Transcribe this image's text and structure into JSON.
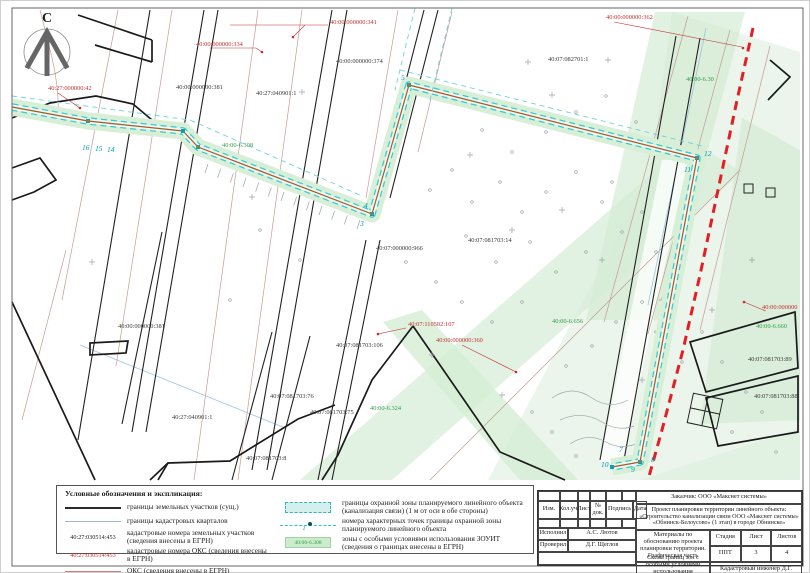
{
  "compass": {
    "north_letter": "С"
  },
  "map": {
    "labels": [
      {
        "text": "40:27:000000:42",
        "x": 48,
        "y": 90,
        "color": "red"
      },
      {
        "text": "40:00:000000:341",
        "x": 330,
        "y": 24,
        "color": "red"
      },
      {
        "text": "40:00:000000:334",
        "x": 196,
        "y": 46,
        "color": "red"
      },
      {
        "text": "40:00:000000:374",
        "x": 336,
        "y": 63,
        "color": "black"
      },
      {
        "text": "40:00:000000:381",
        "x": 176,
        "y": 89,
        "color": "black"
      },
      {
        "text": "40:27:040901:1",
        "x": 256,
        "y": 95,
        "color": "black"
      },
      {
        "text": "40:00:000000:362",
        "x": 606,
        "y": 19,
        "color": "red"
      },
      {
        "text": "40:07:082701:1",
        "x": 548,
        "y": 61,
        "color": "black"
      },
      {
        "text": "40:00-6.30",
        "x": 686,
        "y": 81,
        "color": "green"
      },
      {
        "text": "40:00-6.308",
        "x": 222,
        "y": 147,
        "color": "green"
      },
      {
        "text": "40:07:081703:14",
        "x": 468,
        "y": 242,
        "color": "black"
      },
      {
        "text": "40:07:000000:966",
        "x": 376,
        "y": 250,
        "color": "black"
      },
      {
        "text": "40:00:000000:381",
        "x": 118,
        "y": 328,
        "color": "black"
      },
      {
        "text": "40:27:040901:1",
        "x": 172,
        "y": 419,
        "color": "black"
      },
      {
        "text": "40:07:110502:107",
        "x": 408,
        "y": 326,
        "color": "red"
      },
      {
        "text": "40:00:000000:360",
        "x": 436,
        "y": 342,
        "color": "red"
      },
      {
        "text": "40:00-6.656",
        "x": 552,
        "y": 323,
        "color": "green"
      },
      {
        "text": "40:00-6.660",
        "x": 756,
        "y": 328,
        "color": "green"
      },
      {
        "text": "40:00:000000",
        "x": 762,
        "y": 309,
        "color": "red"
      },
      {
        "text": "40:07:081703:89",
        "x": 748,
        "y": 361,
        "color": "black"
      },
      {
        "text": "40:07:081703:88",
        "x": 754,
        "y": 398,
        "color": "black"
      },
      {
        "text": "40:07:081703:106",
        "x": 336,
        "y": 347,
        "color": "black"
      },
      {
        "text": "40:07:081703:76",
        "x": 270,
        "y": 398,
        "color": "black"
      },
      {
        "text": "40:07:081703:75",
        "x": 310,
        "y": 414,
        "color": "black"
      },
      {
        "text": "40:07:081703:8",
        "x": 246,
        "y": 460,
        "color": "black"
      },
      {
        "text": "40:00-6.324",
        "x": 370,
        "y": 410,
        "color": "green"
      }
    ],
    "vertex_labels": [
      {
        "text": "16",
        "x": 82,
        "y": 150
      },
      {
        "text": "15",
        "x": 95,
        "y": 151
      },
      {
        "text": "14",
        "x": 107,
        "y": 152
      },
      {
        "text": "5",
        "x": 401,
        "y": 80
      },
      {
        "text": "4",
        "x": 364,
        "y": 208
      },
      {
        "text": "3",
        "x": 360,
        "y": 226
      },
      {
        "text": "12",
        "x": 704,
        "y": 156
      },
      {
        "text": "11",
        "x": 684,
        "y": 172
      },
      {
        "text": "7",
        "x": 619,
        "y": 452
      },
      {
        "text": "10",
        "x": 601,
        "y": 467
      },
      {
        "text": "9",
        "x": 631,
        "y": 472
      },
      {
        "text": "8",
        "x": 651,
        "y": 462
      }
    ]
  },
  "legend": {
    "title": "Условные обозначения и экспликация:",
    "left": [
      {
        "sym": "line-bold",
        "text": "границы земельных участков (сущ.)"
      },
      {
        "sym": "line-thin-blue",
        "text": "границы кадастровых кварталов"
      },
      {
        "sym": "code-black",
        "code": "40:27:030514:453",
        "text": "кадастровые номера земельных участков (сведения внесены в ЕГРН)"
      },
      {
        "sym": "code-red",
        "code": "40:27:030514:453",
        "text": "кадастровые номера ОКС (сведения внесены в ЕГРН)"
      },
      {
        "sym": "line-thin-red",
        "text": "ОКС (сведения внесены в ЕГРН)"
      },
      {
        "sym": "line-red-dash",
        "text": "граница МО \"Город Обнинск\""
      }
    ],
    "right": [
      {
        "sym": "zone-box",
        "text": "границы охранной зоны планируемого линейного объекта (канализация связи) (1 м от оси в обе стороны)"
      },
      {
        "sym": "point-line",
        "point_label": "1",
        "text": "номера характерных точек границы охранной зоны планируемого линейного объекта"
      },
      {
        "sym": "zouit-box",
        "code": "40:00-6.308",
        "text": "зоны с особыми условиями использования ЗОУИТ (сведения о границах внесены в ЕГРН)"
      }
    ]
  },
  "title_block": {
    "customer": "Заказчик: ООО «Макснет системы»",
    "project": "Проект планировки территории линейного объекта: «Строительство канализации связи ООО «Макснет системы» «Обнинск-Белоусово» (1 этап) в городе Обнинске»",
    "columns": [
      "Изм.",
      "Кол.уч.",
      "Лист",
      "№ док.",
      "Подпись",
      "Дата"
    ],
    "doc_title": "Материалы по обоснованию проекта планировки территории. Графическая часть",
    "stage_label": "Стадия",
    "sheet_label": "Лист",
    "sheets_label": "Листов",
    "stage": "ППТ",
    "sheet": "3",
    "sheets": "4",
    "drawing_title": "Схема границ зон с особыми условиями использования территорий",
    "scale": "М 1:500",
    "roles": [
      {
        "role": "Исполнил",
        "name": "А.С. Лютов"
      },
      {
        "role": "Проверил",
        "name": "Д.Г. Щеглов"
      }
    ],
    "certifier": "Кадастровый инженер Д.Г. Щеглов"
  }
}
